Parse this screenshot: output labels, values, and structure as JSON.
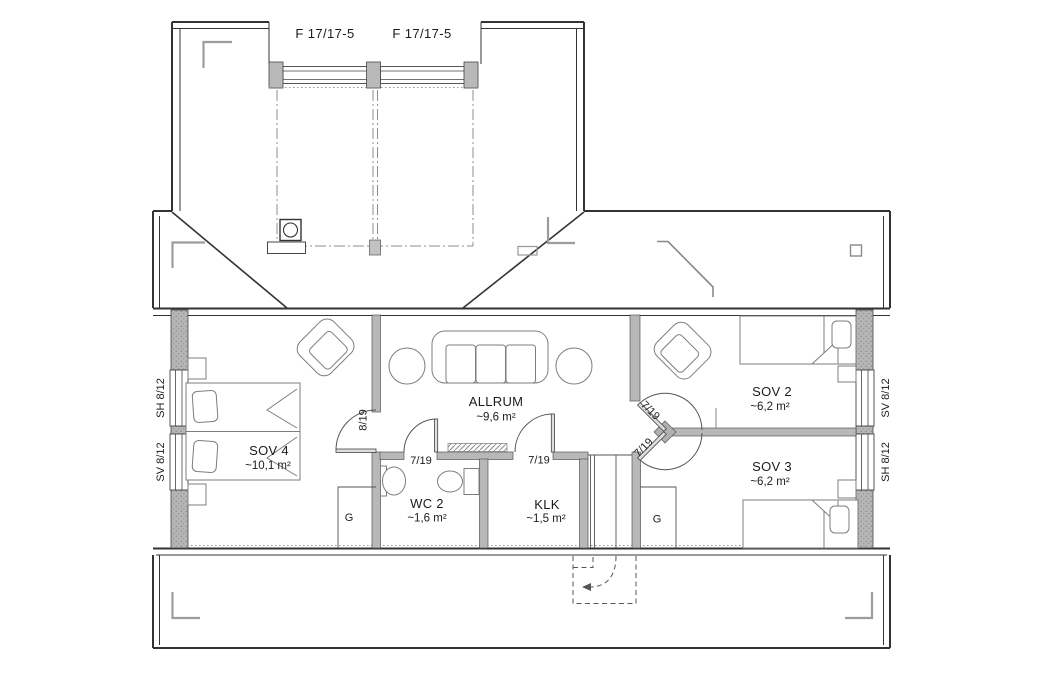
{
  "plan_title": "floor-plan-upper-storey",
  "colors": {
    "background": "#ffffff",
    "wall_line": "#333333",
    "exterior_wall_fill": "#b3b3b3",
    "interior_wall_fill": "#b8b8b8",
    "furniture_line": "#7d7d7d",
    "marker_gray": "#9c9c9c",
    "text": "#1c1c1c"
  },
  "windows": {
    "top": [
      {
        "label": "F 17/17-5"
      },
      {
        "label": "F 17/17-5"
      }
    ],
    "left": [
      {
        "label": "SH 8/12"
      },
      {
        "label": "SV 8/12"
      }
    ],
    "right": [
      {
        "label": "SV 8/12"
      },
      {
        "label": "SH 8/12"
      }
    ]
  },
  "rooms": {
    "allrum": {
      "name": "ALLRUM",
      "area": "~9,6 m²"
    },
    "sov4": {
      "name": "SOV 4",
      "area": "~10,1 m²"
    },
    "sov2": {
      "name": "SOV 2",
      "area": "~6,2 m²"
    },
    "sov3": {
      "name": "SOV 3",
      "area": "~6,2 m²"
    },
    "wc2": {
      "name": "WC 2",
      "area": "~1,6 m²"
    },
    "klk": {
      "name": "KLK",
      "area": "~1,5 m²"
    }
  },
  "doors": {
    "sov4": "8/19",
    "wc2": "7/19",
    "klk": "7/19",
    "sov2": "7/19",
    "sov3": "7/19"
  },
  "wardrobes": {
    "left": "G",
    "right": "G"
  }
}
